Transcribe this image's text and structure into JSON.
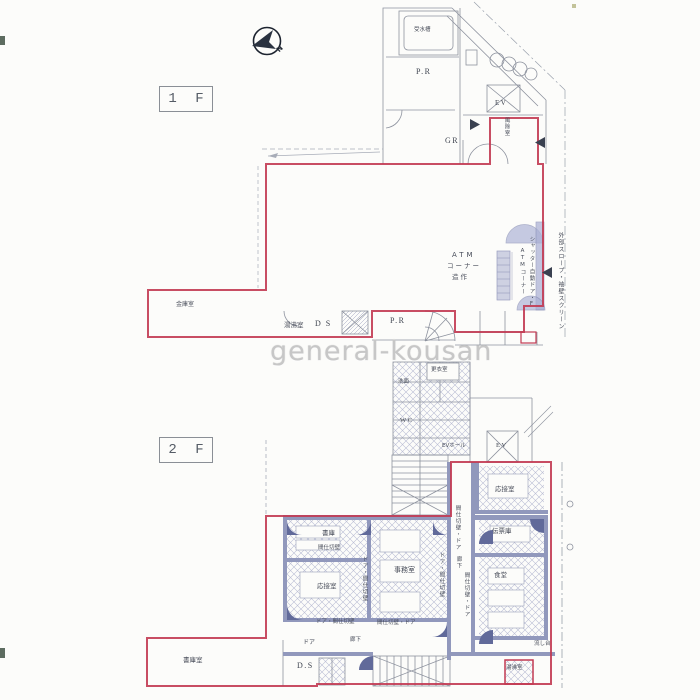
{
  "watermark": "general-kousan",
  "colors": {
    "lease_outline": "#c23a52",
    "partition_fill": "#9198bc",
    "atm_shade": "#a9afd4",
    "plan_line": "#8d929e"
  },
  "floor1": {
    "label": "1 F",
    "north": "N",
    "labels": {
      "water_tank": "受水槽",
      "pr_upper": "P.R",
      "ev": "EV",
      "gr": "GR",
      "fujo": "風除室",
      "atm1": "ATM",
      "atm2": "コーナー",
      "atm3": "造作",
      "shutter": "シャッター自動ドア・F",
      "atm_vert": "ATMコーナー",
      "slope": "外部スロープ・袖壁スクリーン",
      "safe": "金庫室",
      "yuwakashi": "湯沸室",
      "ds": "D S",
      "pr_lower": "P.R"
    }
  },
  "floor2": {
    "label": "2 F",
    "labels": {
      "senmen": "洗面",
      "wc": "WC",
      "koui": "更衣室",
      "ev_hall": "EVホール",
      "ev": "EV",
      "reception_upper": "応接室",
      "shoko": "書庫",
      "majikiri": "間仕切壁",
      "reception": "応接室",
      "office": "事務室",
      "door_majikiri_left": "ドア・間仕切壁",
      "door_majikiri_right": "ドア・間仕切壁",
      "majikiri_door_corridor": "間仕切壁・ドア",
      "rouka_vertical": "廊下",
      "denpyoko": "伝票庫",
      "dining": "食堂",
      "majikiri_door_dining": "間仕切壁・ドア",
      "door_majikiri_bottom": "ドア・間仕切壁",
      "majikiri_door_bottom": "間仕切壁・ドア",
      "rouka": "廊下",
      "door": "ドア",
      "ds": "D.S",
      "yuwakashi": "湯沸室",
      "sink": "流し台",
      "shoko_room": "書庫室"
    }
  }
}
